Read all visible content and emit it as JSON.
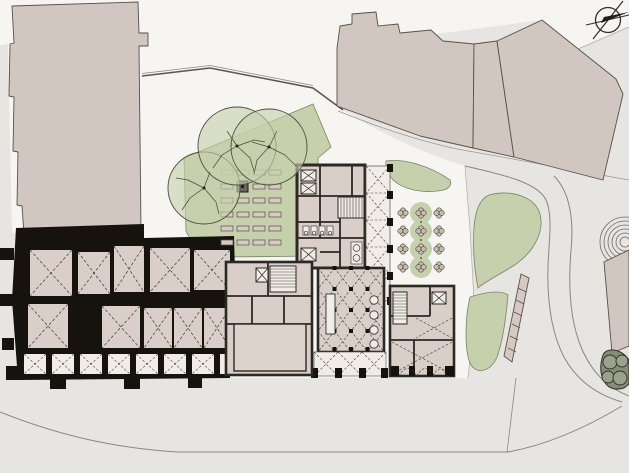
{
  "meta": {
    "title": "Architectural site plan – ground floor",
    "canvas": {
      "width": 629,
      "height": 473
    }
  },
  "scene": {
    "description": "Ground-floor site plan: existing vaulted building with black poché walls, new wing with colonnades and column hall, formal garden with planting beds, three large trees, a 4x3 bosque of small clipped trees, lawn shapes, curved streets and surrounding context buildings",
    "north_arrow": "compass rose, top-right corner",
    "counts": {
      "large_trees": 3,
      "small_trees": 12,
      "planting_beds": 23,
      "context_building_parcels": 5,
      "lawn_shapes": 3
    }
  },
  "palette": {
    "paper": "#f6f5f2",
    "ground": "#e7e5e2",
    "context": "#d2c6c0",
    "context_edge": "#575149",
    "room": "#d9cec8",
    "room_light": "#f1ece7",
    "hall_light": "#ddd3cc",
    "black": "#16130f",
    "wall": "#2c2824",
    "green": "#c6d0ad",
    "green_edge": "#7a8268",
    "dark_green": "#868c78",
    "dark_green_circle": "#9ba18c",
    "bed": "#d8cabd",
    "curb": "#8a8781",
    "dash": "#3c3a36",
    "tree_stroke": "#4c4c43"
  }
}
